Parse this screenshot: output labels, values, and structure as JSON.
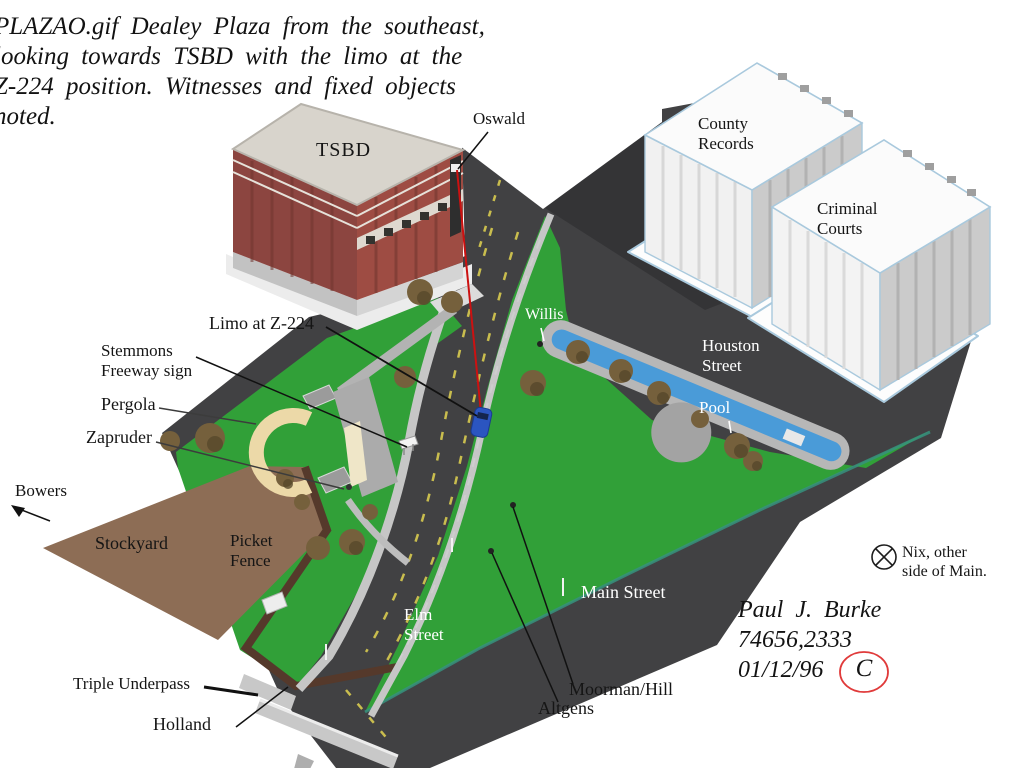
{
  "caption_lines": [
    "PLAZAO.gif Dealey Plaza from the southeast,",
    "looking towards TSBD with the limo at the",
    "Z-224 position. Witnesses and fixed objects",
    "noted."
  ],
  "buildings": {
    "tsbd": "TSBD",
    "county_records_1": "County",
    "county_records_2": "Records",
    "criminal_courts_1": "Criminal",
    "criminal_courts_2": "Courts"
  },
  "streets": {
    "houston_1": "Houston",
    "houston_2": "Street",
    "elm_1": "Elm",
    "elm_2": "Street",
    "main": "Main Street"
  },
  "features": {
    "limo": "Limo at Z-224",
    "stemmons_1": "Stemmons",
    "stemmons_2": "Freeway sign",
    "pergola": "Pergola",
    "stockyard": "Stockyard",
    "picket_fence_1": "Picket",
    "picket_fence_2": "Fence",
    "triple_underpass": "Triple Underpass",
    "pool": "Pool"
  },
  "witnesses": {
    "oswald": "Oswald",
    "zapruder": "Zapruder",
    "bowers": "Bowers",
    "holland": "Holland",
    "willis": "Willis",
    "moorman_hill": "Moorman/Hill",
    "altgens": "Altgens",
    "nix_1": "Nix, other",
    "nix_2": "side of Main."
  },
  "signature": {
    "name": "Paul J. Burke",
    "compuserve_id": "74656,2333",
    "date": "01/12/96",
    "copyright_letter": "C"
  },
  "colors": {
    "road": "#414143",
    "grass": "#31a038",
    "pool_water": "#4a9bd8",
    "stockyard_dirt": "#8d6d55",
    "tsbd_brick": "#9a4c43",
    "trajectory_line": "#cc1111",
    "copyright_circle": "#e03a3a",
    "label_text": "#151515",
    "street_label_text": "#ffffff"
  }
}
